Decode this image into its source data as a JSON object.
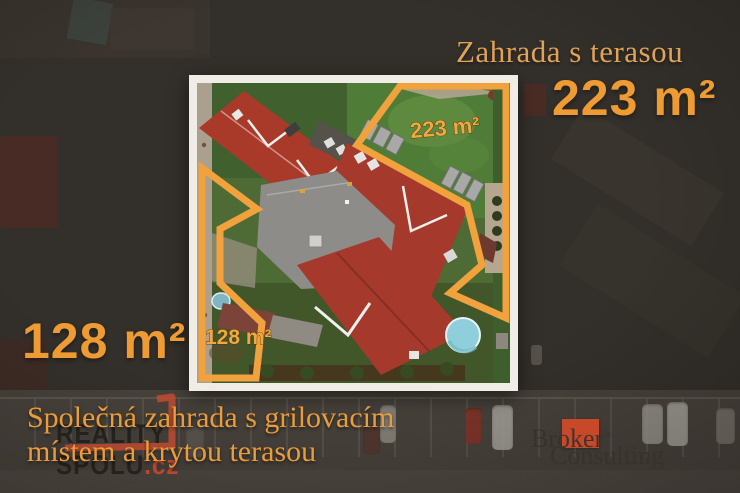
{
  "headline": {
    "title": "Zahrada s terasou",
    "area": "223 m²"
  },
  "side_area": {
    "area": "128 m²"
  },
  "caption": {
    "line1": "Společná zahrada s grilovacím",
    "line2": "místem a krytou terasou"
  },
  "photo_overlay": {
    "garden_right_label": "223 m²",
    "garden_left_label": "128 m²"
  },
  "watermark": {
    "word1": "REALITY",
    "word2": "SPOLU",
    "tld": ".cz"
  },
  "broker_logo": {
    "pre": "Br",
    "mid": "ok",
    "post": "er",
    "registered": "®",
    "second_word": "Consulting"
  },
  "colors": {
    "accent_orange": "#F2A23C",
    "big_number_orange": "#EE9B33",
    "heading_tan": "#DFA257",
    "caption_orange": "#EA9C3B",
    "watermark_dark": "#201D1A",
    "watermark_red": "#C9472E",
    "broker_square_red": "#C7492A",
    "photo_frame_white": "#F0EDE7",
    "roof_red": "#A93A2A",
    "terrace_roof_gray": "#8D8C88",
    "grass_green": "#4E6B35",
    "pool_blue": "#8ECFDB",
    "background_dark": "#3A3631"
  }
}
